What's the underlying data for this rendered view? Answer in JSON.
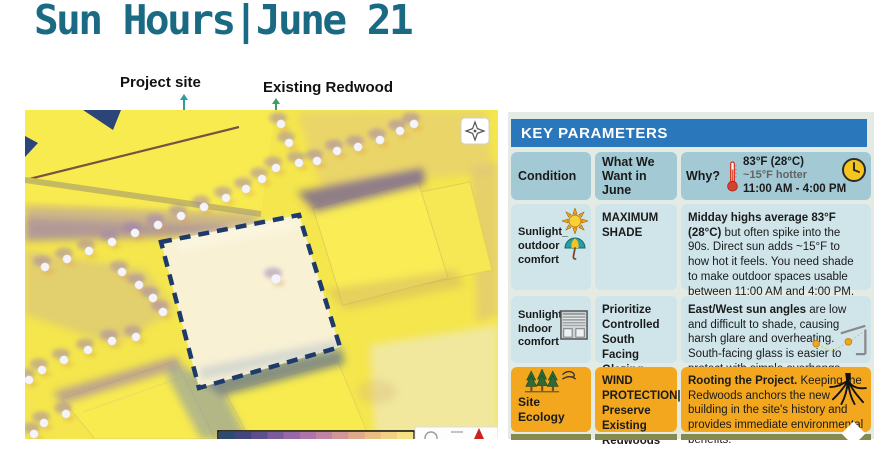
{
  "slide": {
    "title": "Sun Hours|June 21"
  },
  "map": {
    "labels": {
      "project_site": "Project site",
      "existing_redwood": "Existing Redwood"
    },
    "site_outline": "136,132 274,105 315,237 174,278",
    "trees": [
      [
        20,
        157
      ],
      [
        42,
        149
      ],
      [
        64,
        141
      ],
      [
        87,
        132
      ],
      [
        110,
        123
      ],
      [
        133,
        115
      ],
      [
        156,
        106
      ],
      [
        179,
        97
      ],
      [
        201,
        88
      ],
      [
        221,
        79
      ],
      [
        237,
        69
      ],
      [
        251,
        58
      ],
      [
        256,
        14
      ],
      [
        264,
        33
      ],
      [
        274,
        53
      ],
      [
        292,
        51
      ],
      [
        312,
        41
      ],
      [
        333,
        37
      ],
      [
        355,
        30
      ],
      [
        375,
        21
      ],
      [
        389,
        14
      ],
      [
        97,
        162
      ],
      [
        114,
        175
      ],
      [
        128,
        188
      ],
      [
        138,
        202
      ],
      [
        111,
        227
      ],
      [
        87,
        231
      ],
      [
        63,
        240
      ],
      [
        39,
        250
      ],
      [
        17,
        260
      ],
      [
        4,
        270
      ],
      [
        41,
        304
      ],
      [
        19,
        313
      ],
      [
        9,
        324
      ]
    ],
    "redwood": [
      251,
      169
    ],
    "legend_colors": [
      "#2e4a6e",
      "#45457e",
      "#5d4f8e",
      "#7a5c9c",
      "#9668a6",
      "#ad74a8",
      "#c084a2",
      "#d29698",
      "#dfa98c",
      "#e9bc84",
      "#f0d083",
      "#f5e285"
    ],
    "colors": {
      "leader_project": "#2f9d9d",
      "leader_redwood": "#3f9f63",
      "site_dash": "#1d3a6b",
      "base_yellow": "#f4e64c"
    }
  },
  "panel": {
    "header": "KEY PARAMETERS",
    "accent": "#2b77bb",
    "columns": [
      "Condition",
      "What We Want in June",
      "Why?"
    ],
    "why_header": {
      "temp": "83°F (28°C)",
      "hotter": "~15°F hotter",
      "time": "11:00 AM - 4:00 PM"
    },
    "rows": [
      {
        "condition": "Sunlight_ outdoor comfort",
        "want": "MAXIMUM SHADE",
        "why_lead": "Midday highs average 83°F (28°C)",
        "why_rest": " but often spike into the 90s. Direct sun adds ~15°F to how hot it feels. You need shade to make outdoor spaces usable between 11:00 AM and 4:00 PM."
      },
      {
        "condition": "Sunlight_ Indoor comfort",
        "want": "Prioritize Controlled South Facing Glazing",
        "why_lead": "East/West sun angles",
        "why_rest": " are low and difficult to shade, causing harsh glare and overheating. South-facing glass is easier to protect with simple overhangs."
      },
      {
        "condition": "Site Ecology",
        "want": "WIND PROTECTION| Preserve Existing Redwoods",
        "why_lead": "Rooting the Project.",
        "why_rest": " Keeping the Redwoods anchors the new building in the site's history and provides immediate environmental benefits."
      }
    ]
  }
}
